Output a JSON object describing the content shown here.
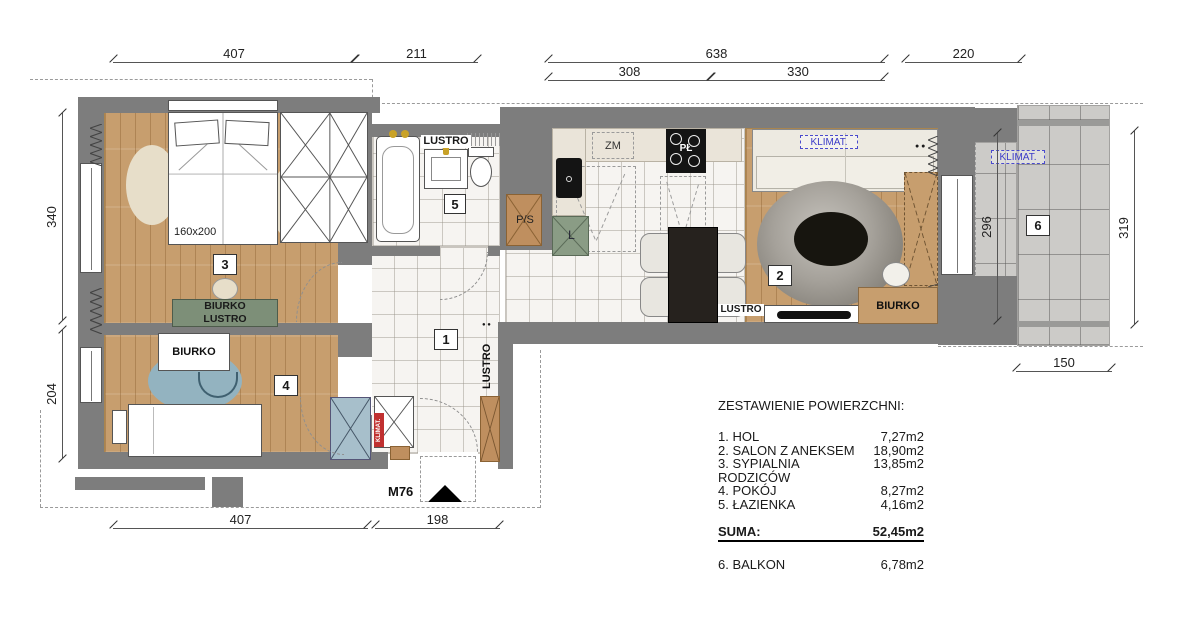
{
  "dims": {
    "top407": "407",
    "top211": "211",
    "top638": "638",
    "top308": "308",
    "top330": "330",
    "top220": "220",
    "left340": "340",
    "left204": "204",
    "right319": "319",
    "right296": "296",
    "right150": "150",
    "bottom407": "407",
    "bottom198": "198"
  },
  "rooms": {
    "hall": "1",
    "salon": "2",
    "bedroom": "3",
    "kidroom": "4",
    "bathroom": "5",
    "balcony": "6"
  },
  "labels": {
    "bed_size": "160x200",
    "bedroom_desk_line1": "BIURKO",
    "bedroom_desk_line2": "LUSTRO",
    "kidroom_desk": "BIURKO",
    "salon_desk": "BIURKO",
    "salon_mirror": "LUSTRO",
    "hall_mirror": "LUSTRO",
    "bathroom_mirror": "LUSTRO",
    "klimat_salon": "KLIMAT.",
    "klimat_balcony": "KLIMAT.",
    "klimat_riser": "KLIMAT.",
    "kitchen_dishwasher": "ZM",
    "kitchen_cooktop": "PŁ",
    "kitchen_fridge": "L",
    "washer_dryer": "P/S",
    "entrance_unit": "M76",
    "outlet_dots": "● ●"
  },
  "legend": {
    "title": "ZESTAWIENIE POWIERZCHNI:",
    "items": [
      {
        "label": "1. HOL",
        "value": "7,27m2"
      },
      {
        "label": "2. SALON Z ANEKSEM",
        "value": "18,90m2"
      },
      {
        "label": "3. SYPIALNIA RODZICÓW",
        "value": "13,85m2"
      },
      {
        "label": "4. POKÓJ",
        "value": "8,27m2"
      },
      {
        "label": "5. ŁAZIENKA",
        "value": "4,16m2"
      }
    ],
    "total_label": "SUMA:",
    "total_value": "52,45m2",
    "balcony_label": "6. BALKON",
    "balcony_value": "6,78m2"
  },
  "colors": {
    "wall": "#7d7d7d",
    "wood_floor": "#c79e6e",
    "marble_floor": "#f6f4f1",
    "concrete_floor": "#cccbc8",
    "desk_green": "#7d8f78",
    "rug_blue": "#93b3c0",
    "wardrobe_blue": "#a7bfcb",
    "cabinet_brown": "#bf8f5f",
    "klimat_blue": "#3a3ac8",
    "riser_red": "#c03030"
  }
}
